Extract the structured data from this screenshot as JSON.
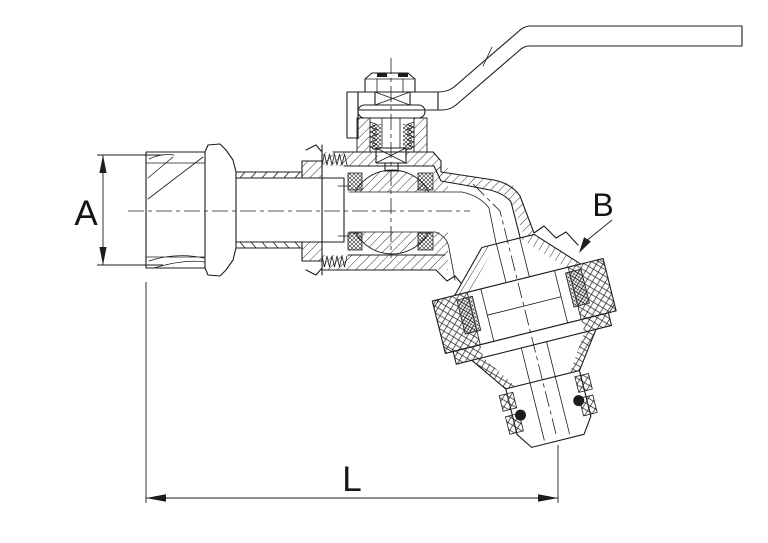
{
  "page": {
    "background_color": "#ffffff",
    "ink_color": "#1d1d1d",
    "oring_fill_color": "#111111"
  },
  "drawing": {
    "type": "sectioned technical drawing of a lever-handle ball valve bibcock with hose union outlet",
    "labels": {
      "dim_a": "A",
      "dim_b": "B",
      "dim_l": "L"
    }
  }
}
